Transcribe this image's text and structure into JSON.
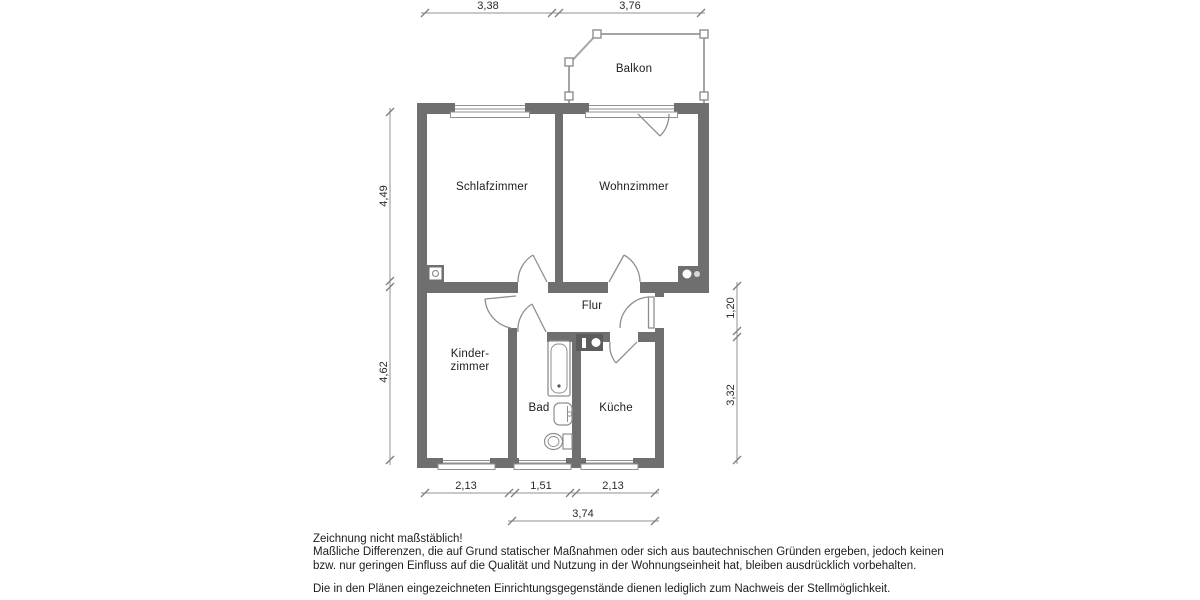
{
  "plan": {
    "rooms": {
      "balkon": "Balkon",
      "schlafzimmer": "Schlafzimmer",
      "wohnzimmer": "Wohnzimmer",
      "flur": "Flur",
      "kinderzimmer_line1": "Kinder-",
      "kinderzimmer_line2": "zimmer",
      "bad": "Bad",
      "kueche": "Küche"
    },
    "dims": {
      "top": [
        "3,38",
        "3,76"
      ],
      "left": [
        "4,49",
        "4,62"
      ],
      "right": [
        "1,20",
        "3,32"
      ],
      "bottom": [
        "2,13",
        "1,51",
        "2,13"
      ],
      "bottom_total": "3,74"
    }
  },
  "notes": {
    "line1": "Zeichnung nicht maßstäblich!",
    "line2": "Maßliche Differenzen, die auf Grund statischer Maßnahmen oder sich aus bautechnischen Gründen ergeben, jedoch keinen",
    "line3": "bzw. nur geringen Einfluss auf die Qualität und Nutzung in der Wohnungseinheit hat, bleiben ausdrücklich vorbehalten.",
    "line4": "Die in den Plänen eingezeichneten Einrichtungsgegenstände dienen lediglich zum Nachweis der Stellmöglichkeit."
  },
  "colors": {
    "wall": "#6f6f6f",
    "line": "#8f8f8f",
    "text": "#1d1d1d"
  }
}
